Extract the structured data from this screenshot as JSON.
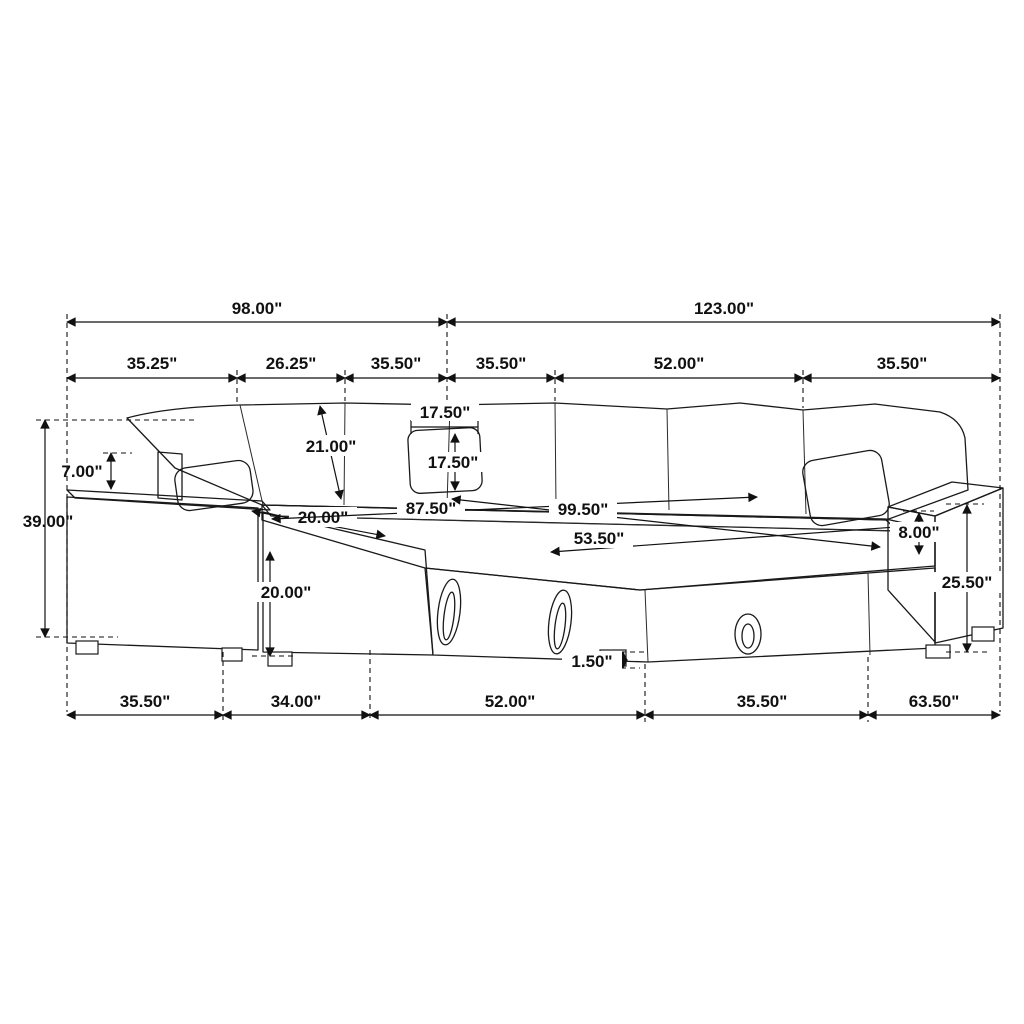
{
  "figure": {
    "type": "furniture-dimension-diagram",
    "subject": "U-shaped sleeper sectional sofa, three-quarter line-art view with corduroy texture",
    "unit": "inches",
    "line_color": "#1a1a1a",
    "shade_color": "#b3b3b3"
  },
  "dims": {
    "top_total_left": "98.00\"",
    "top_total_right": "123.00\"",
    "back_seg_1": "35.25\"",
    "back_seg_2": "26.25\"",
    "back_seg_3": "35.50\"",
    "back_seg_4": "35.50\"",
    "back_seg_5": "52.00\"",
    "back_seg_6": "35.50\"",
    "pillow_above_arm": "7.00\"",
    "overall_height": "39.00\"",
    "backrest_length": "21.00\"",
    "pillow_width": "17.50\"",
    "pillow_height": "17.50\"",
    "seat_depth": "20.00\"",
    "inner_width_left": "87.50\"",
    "inner_width_full": "99.50\"",
    "bed_width": "53.50\"",
    "seat_front_height": "20.00\"",
    "arm_above_seat": "8.00\"",
    "arm_total_height": "25.50\"",
    "leg_height": "1.50\"",
    "front_seg_1": "35.50\"",
    "front_seg_2": "34.00\"",
    "front_seg_3": "52.00\"",
    "front_seg_4": "35.50\"",
    "front_seg_5": "63.50\""
  }
}
